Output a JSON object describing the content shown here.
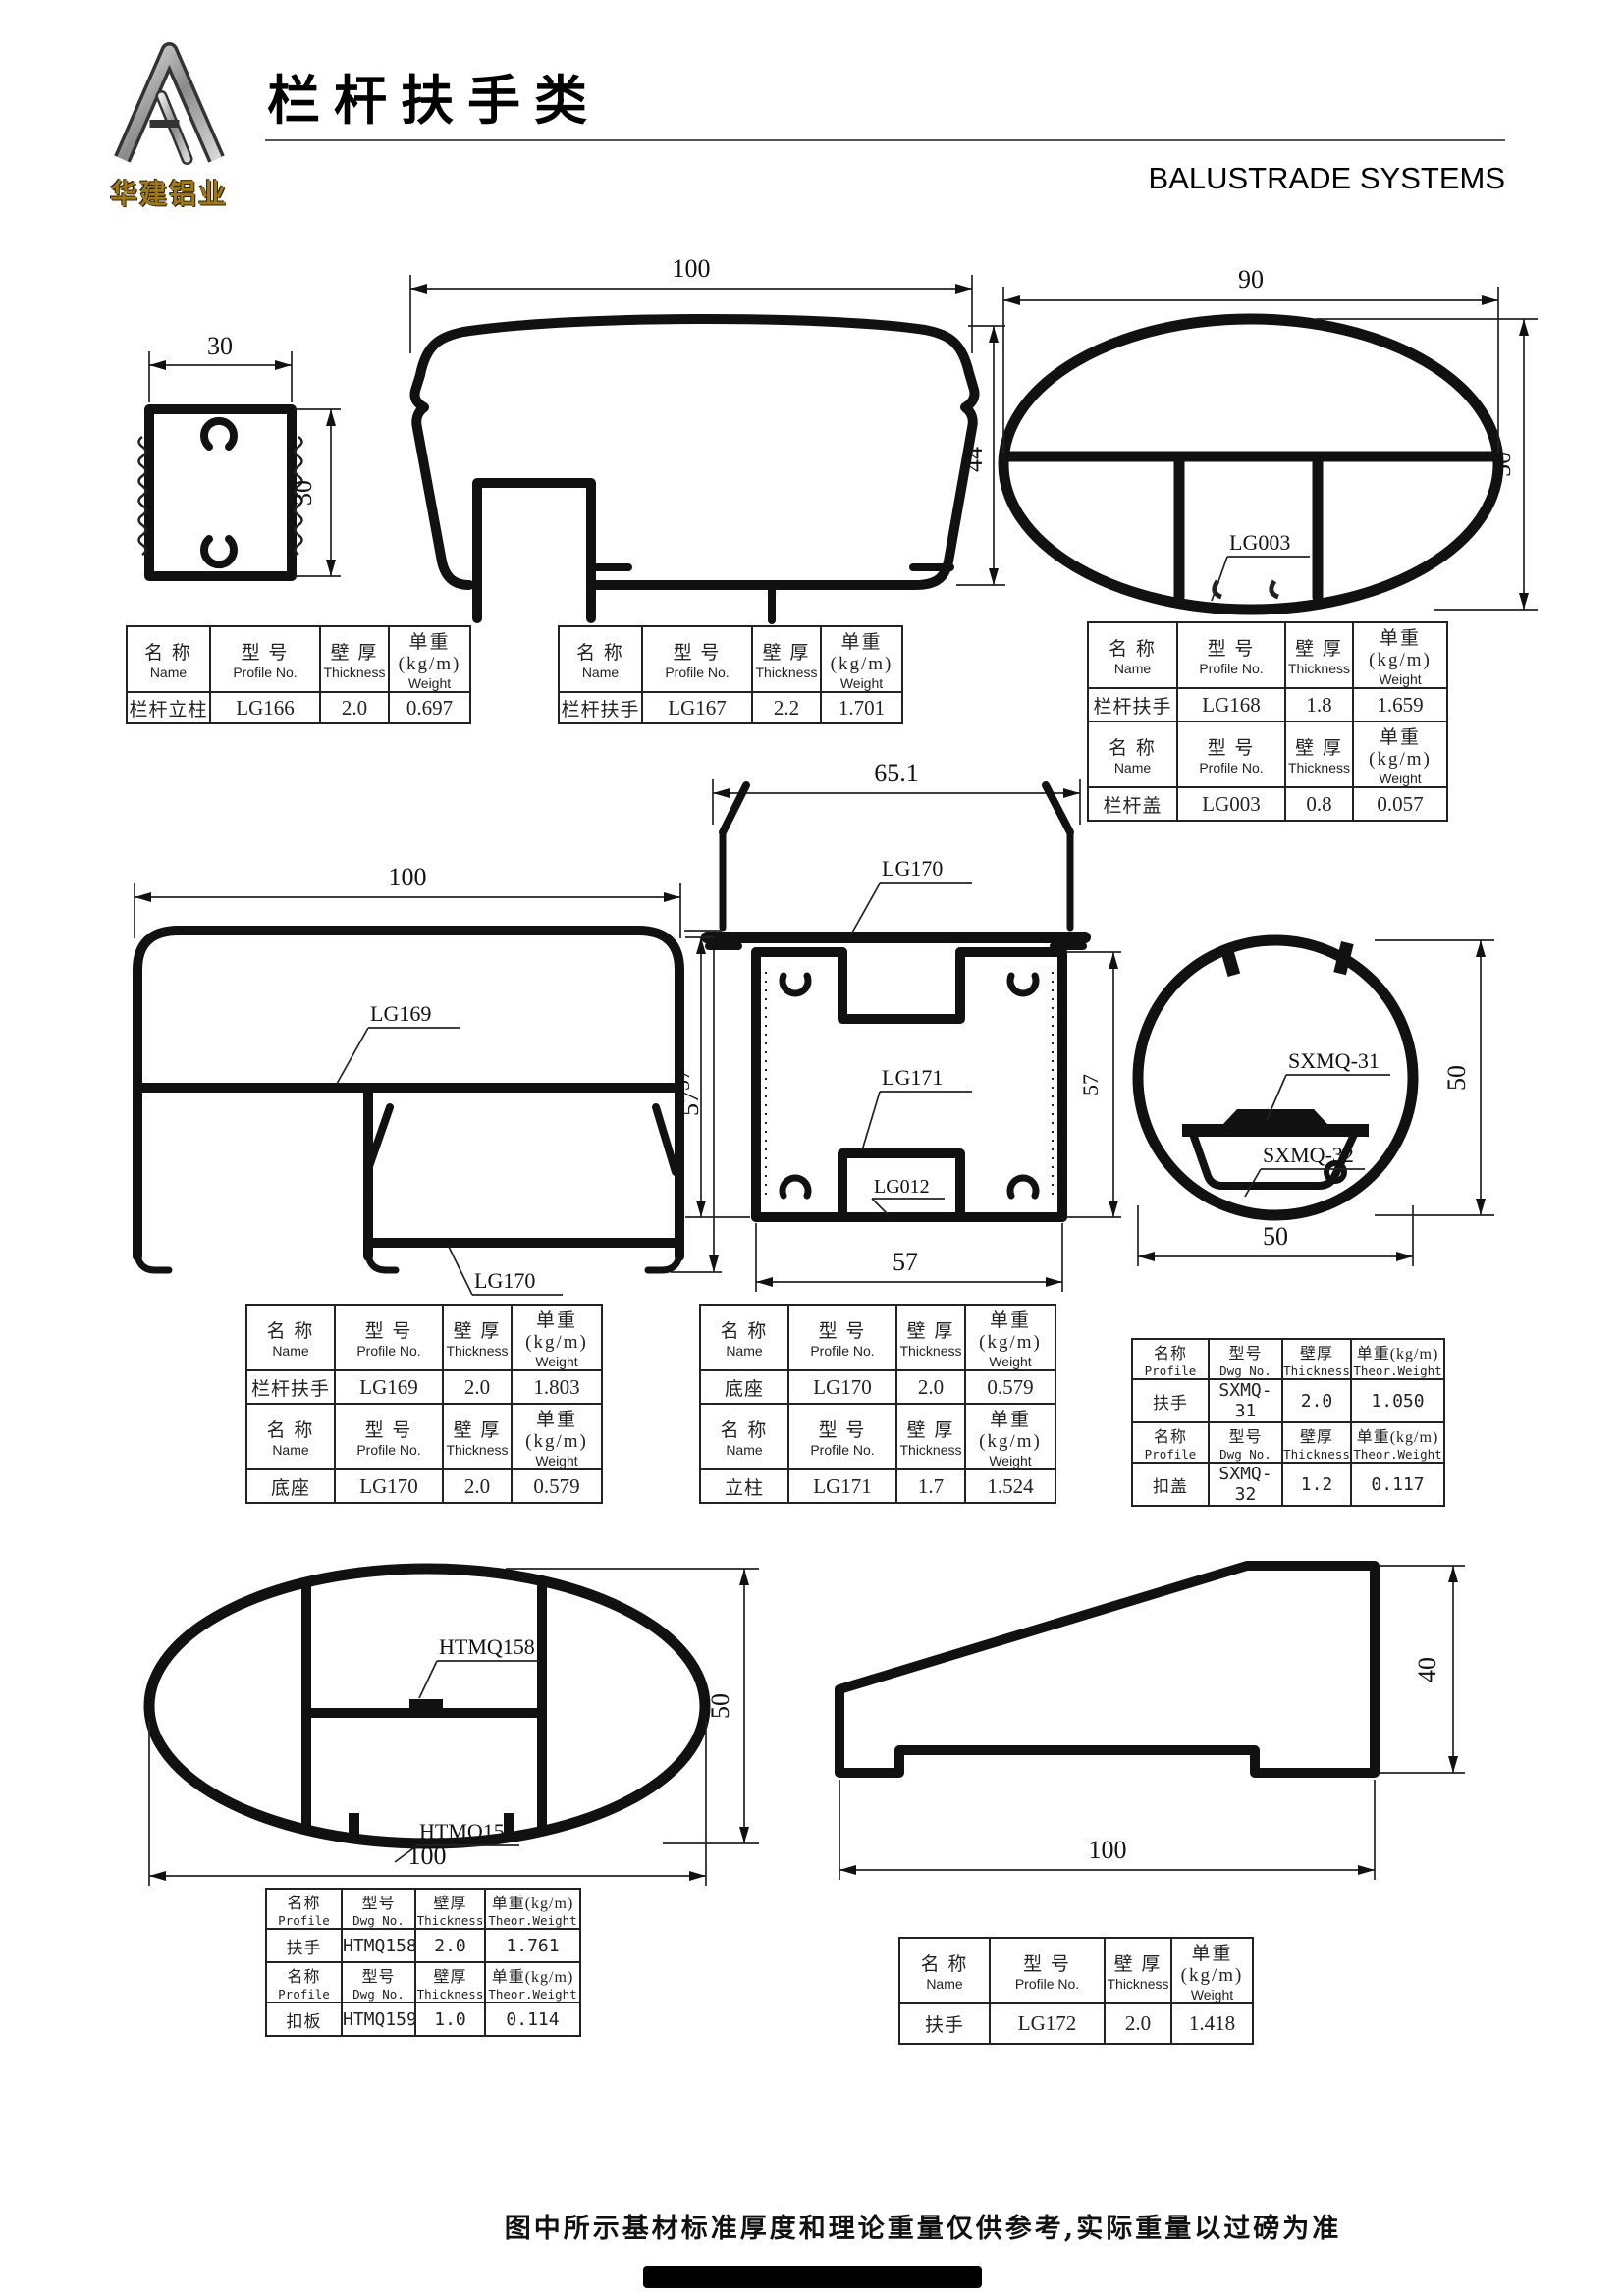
{
  "header": {
    "logo_text": "华建铝业",
    "title_zh": "栏杆扶手类",
    "title_en": "BALUSTRADE SYSTEMS"
  },
  "headers_a": {
    "name_zh": "名 称",
    "name_en": "Name",
    "model_zh": "型 号",
    "model_en": "Profile No.",
    "thick_zh": "壁 厚",
    "thick_en": "Thickness",
    "weight_zh": "单重(kg/m)",
    "weight_en": "Weight"
  },
  "headers_b": {
    "name_zh": "名称",
    "name_en": "Profile",
    "model_zh": "型号",
    "model_en": "Dwg No.",
    "thick_zh": "壁厚",
    "thick_en": "Thickness",
    "weight_zh": "单重(kg/m)",
    "weight_en": "Theor.Weight"
  },
  "tables": {
    "t1": {
      "rows": [
        {
          "name": "栏杆立柱",
          "model": "LG166",
          "thickness": "2.0",
          "weight": "0.697"
        }
      ]
    },
    "t2": {
      "rows": [
        {
          "name": "栏杆扶手",
          "model": "LG167",
          "thickness": "2.2",
          "weight": "1.701"
        }
      ]
    },
    "t3": {
      "rows": [
        {
          "name": "栏杆扶手",
          "model": "LG168",
          "thickness": "1.8",
          "weight": "1.659"
        },
        {
          "name": "栏杆盖",
          "model": "LG003",
          "thickness": "0.8",
          "weight": "0.057"
        }
      ]
    },
    "t4": {
      "rows": [
        {
          "name": "栏杆扶手",
          "model": "LG169",
          "thickness": "2.0",
          "weight": "1.803"
        },
        {
          "name": "底座",
          "model": "LG170",
          "thickness": "2.0",
          "weight": "0.579"
        }
      ]
    },
    "t5": {
      "rows": [
        {
          "name": "底座",
          "model": "LG170",
          "thickness": "2.0",
          "weight": "0.579"
        },
        {
          "name": "立柱",
          "model": "LG171",
          "thickness": "1.7",
          "weight": "1.524"
        }
      ]
    },
    "t6": {
      "rows": [
        {
          "name": "扶手",
          "model": "SXMQ-31",
          "thickness": "2.0",
          "weight": "1.050"
        },
        {
          "name": "扣盖",
          "model": "SXMQ-32",
          "thickness": "1.2",
          "weight": "0.117"
        }
      ]
    },
    "t7": {
      "rows": [
        {
          "name": "扶手",
          "model": "HTMQ158",
          "thickness": "2.0",
          "weight": "1.761"
        },
        {
          "name": "扣板",
          "model": "HTMQ159",
          "thickness": "1.0",
          "weight": "0.114"
        }
      ]
    },
    "t8": {
      "rows": [
        {
          "name": "扶手",
          "model": "LG172",
          "thickness": "2.0",
          "weight": "1.418"
        }
      ]
    }
  },
  "drawings": {
    "lg166": {
      "dim_top": "30",
      "dim_right": "30"
    },
    "lg167": {
      "dim_top": "100",
      "dim_right": "44"
    },
    "lg168": {
      "dim_top": "90",
      "dim_right": "50",
      "label1": "LG003"
    },
    "lg169": {
      "dim_top": "100",
      "dim_right": "57",
      "label1": "LG169",
      "label2": "LG170"
    },
    "lg170_171": {
      "dim_top": "65.1",
      "dim_left": "57",
      "dim_right": "57",
      "dim_bottom": "57",
      "label1": "LG170",
      "label2": "LG171",
      "label3": "LG012"
    },
    "sxmq": {
      "dim_right": "50",
      "dim_bottom": "50",
      "label1": "SXMQ-31",
      "label2": "SXMQ-32"
    },
    "htmq": {
      "dim_right": "50",
      "dim_bottom": "100",
      "label1": "HTMQ158",
      "label2": "HTMQ159"
    },
    "lg172": {
      "dim_right": "40",
      "dim_bottom": "100"
    }
  },
  "footer": {
    "note": "图中所示基材标准厚度和理论重量仅供参考,实际重量以过磅为准"
  }
}
